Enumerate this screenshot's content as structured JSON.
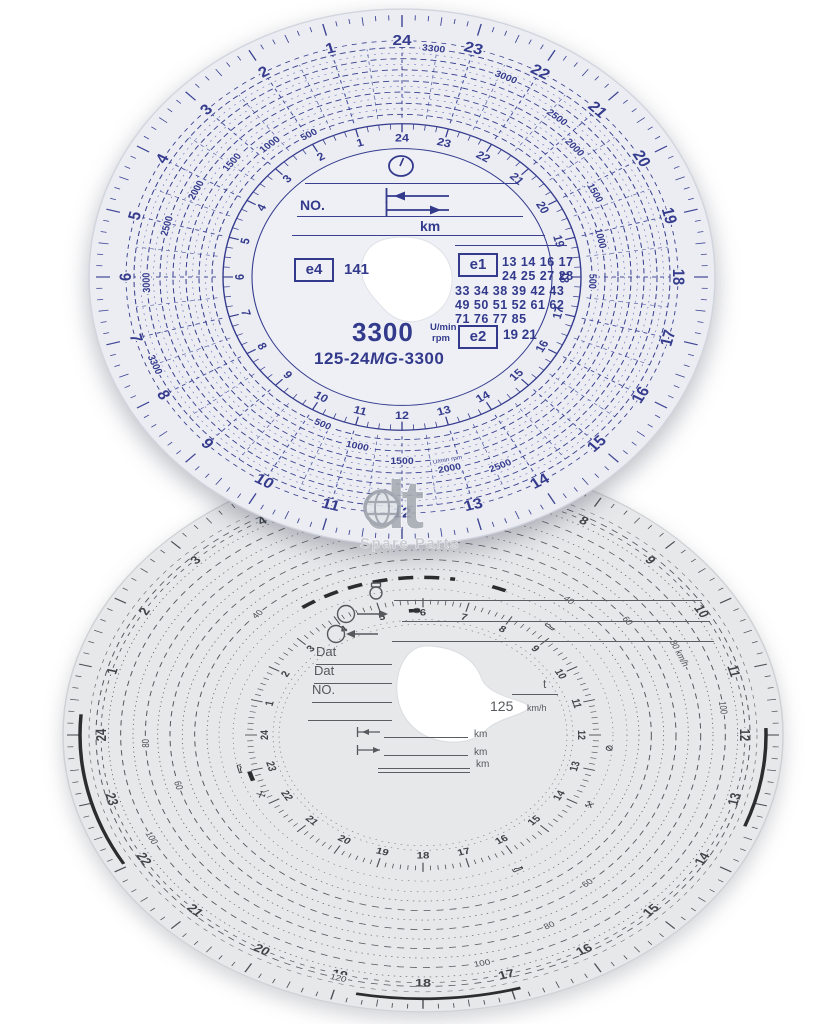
{
  "page": {
    "background": "#ffffff"
  },
  "watermark": {
    "brand": "dt",
    "subtitle": "Spare Parts"
  },
  "top_disc": {
    "description": "tachograph rpm recording disc, blue print",
    "paper_color": "#ebedf3",
    "ink_color": "#353b8d",
    "hours": [
      "1",
      "2",
      "3",
      "4",
      "5",
      "6",
      "7",
      "8",
      "9",
      "10",
      "11",
      "12",
      "13",
      "14",
      "15",
      "16",
      "17",
      "18",
      "19",
      "20",
      "21",
      "22",
      "23",
      "24"
    ],
    "rpm_circles": [
      "500",
      "1000",
      "1500",
      "2000",
      "2500",
      "3000",
      "3300"
    ],
    "rpm_spiral_labels": [
      {
        "text": "3300",
        "hour": 23.55
      },
      {
        "text": "3000",
        "hour": 22.4
      },
      {
        "text": "2500",
        "hour": 21.35
      },
      {
        "text": "2000",
        "hour": 20.75
      },
      {
        "text": "1500",
        "hour": 19.8
      },
      {
        "text": "1000",
        "hour": 18.85
      },
      {
        "text": "500",
        "hour": 17.9
      },
      {
        "text": "500",
        "hour": 1.95
      },
      {
        "text": "1000",
        "hour": 2.7
      },
      {
        "text": "1500",
        "hour": 3.45
      },
      {
        "text": "2000",
        "hour": 4.25
      },
      {
        "text": "2500",
        "hour": 5.05
      },
      {
        "text": "3000",
        "hour": 6.1
      },
      {
        "text": "3300",
        "hour": 7.5
      },
      {
        "text": "500",
        "hour": 10.35
      },
      {
        "text": "1000",
        "hour": 11.15
      },
      {
        "text": "1500",
        "hour": 12.0
      },
      {
        "text": "2000",
        "hour": 12.8,
        "extra": "U/min rpm"
      },
      {
        "text": "2500",
        "hour": 13.6
      }
    ],
    "center": {
      "no_label": "NO.",
      "km_label": "km",
      "e4_mark": "e4",
      "e4_value": "141",
      "e1_mark": "e1",
      "e1_rows": [
        "13 14 16 17",
        "24 25 27 28",
        "33 34 38 39 42 43",
        "49 50 51 52 61 62",
        "71 76 77 85"
      ],
      "e2_mark": "e2",
      "e2_value": "19 21",
      "rpm_value": "3300",
      "rpm_unit_top": "U/min",
      "rpm_unit_bottom": "rpm",
      "model_prefix": "125-24",
      "model_mg": "MG",
      "model_suffix": "-3300"
    }
  },
  "bottom_disc": {
    "description": "tachograph speed recording disc 125 km/h, grey print",
    "paper_color": "#e7e8ea",
    "ink_color": "#55585c",
    "hours": [
      "1",
      "2",
      "3",
      "4",
      "5",
      "6",
      "7",
      "8",
      "9",
      "10",
      "11",
      "12",
      "13",
      "14",
      "15",
      "16",
      "17",
      "18",
      "19",
      "20",
      "21",
      "22",
      "23",
      "24"
    ],
    "speed_circle_values": [
      30,
      40,
      50,
      60,
      70,
      80,
      90,
      100,
      110,
      120
    ],
    "speed_labels": [
      {
        "text": "40",
        "hour": 8.65
      },
      {
        "text": "40",
        "hour": 2.9
      },
      {
        "text": "60",
        "hour": 9.6
      },
      {
        "text": "60",
        "hour": 23.0
      },
      {
        "text": "60",
        "hour": 15.3
      },
      {
        "text": "80",
        "hour": 23.85
      },
      {
        "text": "80",
        "hour": 16.2
      },
      {
        "text": "80 km/h",
        "hour": 10.5
      },
      {
        "text": "100",
        "hour": 11.55
      },
      {
        "text": "100",
        "hour": 22.25
      },
      {
        "text": "100",
        "hour": 17.25
      },
      {
        "text": "120",
        "hour": 19.0
      }
    ],
    "trace_marks": {
      "rim_arcs_hours": [
        [
          22.05,
          24.3
        ],
        [
          11.9,
          13.35
        ],
        [
          16.9,
          18.75
        ]
      ],
      "dashed_arc_hours": [
        3.6,
        6.6
      ],
      "segments": [
        {
          "hour": 5.8,
          "r": 162
        },
        {
          "hour": 22.85,
          "r": 180
        },
        {
          "hour": 7.45,
          "r": 205
        }
      ]
    },
    "mode_icons": [
      {
        "type": "bed",
        "hour": 23.1,
        "r": 188
      },
      {
        "type": "bed",
        "hour": 8.8,
        "r": 190
      },
      {
        "type": "bed",
        "hour": 16.1,
        "r": 198
      },
      {
        "type": "hammers",
        "hour": 22.3,
        "r": 180
      },
      {
        "type": "hammers",
        "hour": 13.9,
        "r": 190
      },
      {
        "type": "slash",
        "hour": 12.35,
        "r": 187
      },
      {
        "type": "slash",
        "hour": 5.85,
        "r": 162
      }
    ],
    "center": {
      "dat1_label": "Dat",
      "dat2_label": "Dat",
      "no_label": "NO.",
      "t_label": "t",
      "speed_value": "125",
      "speed_unit": "km/h",
      "km_label_1": "km",
      "km_label_2": "km",
      "km_label_3": "km"
    }
  }
}
